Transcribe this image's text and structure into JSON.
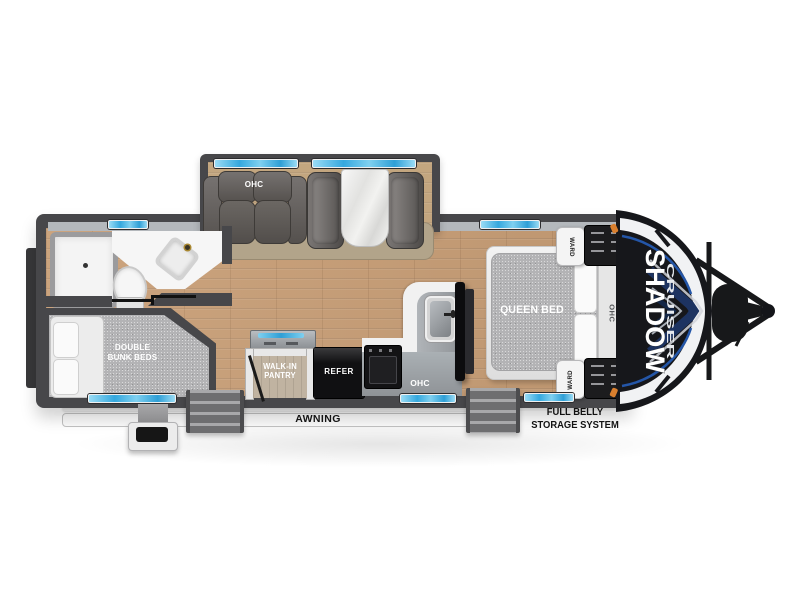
{
  "brand": {
    "primary": "SHADOW",
    "secondary": "CRUISER"
  },
  "living": {
    "sofa_ohc": "OHC"
  },
  "kitchen": {
    "counter_ohc": "OHC",
    "refrigerator": "REFER",
    "pantry_line1": "WALK-IN",
    "pantry_line2": "PANTRY"
  },
  "bedroom": {
    "bed_label": "QUEEN BED",
    "headboard_ohc": "OHC",
    "ward_front": "WARD",
    "ward_rear": "WARD"
  },
  "bunkroom": {
    "label_line1": "DOUBLE",
    "label_line2": "BUNK BEDS"
  },
  "exterior": {
    "awning_label": "AWNING",
    "storage_line1": "FULL BELLY",
    "storage_line2": "STORAGE SYSTEM"
  },
  "colors": {
    "wall_gray": "#47474a",
    "wood_floor": "#c89e76",
    "window_blue": "#45b6e8",
    "brand_navy": "#1d3361",
    "accent_blue": "#2456a8",
    "slide_rug": "#b2a48a"
  }
}
